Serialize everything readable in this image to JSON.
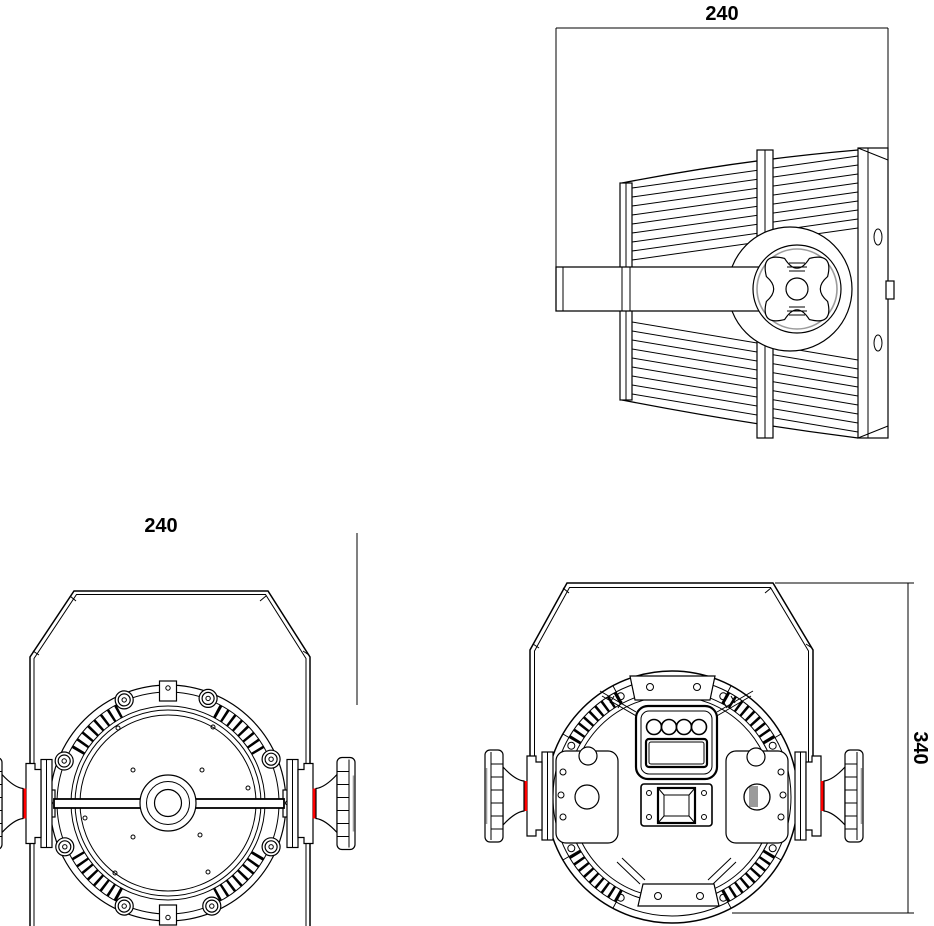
{
  "drawing": {
    "views": {
      "top": {
        "dimension_value": "240"
      },
      "front": {
        "dimension_value": "240"
      },
      "rear": {
        "dimension_value": "340"
      }
    },
    "colors": {
      "line": "#000000",
      "background": "#ffffff",
      "accent_red": "#ff0000",
      "detail_gray": "#9b9b9b"
    }
  }
}
